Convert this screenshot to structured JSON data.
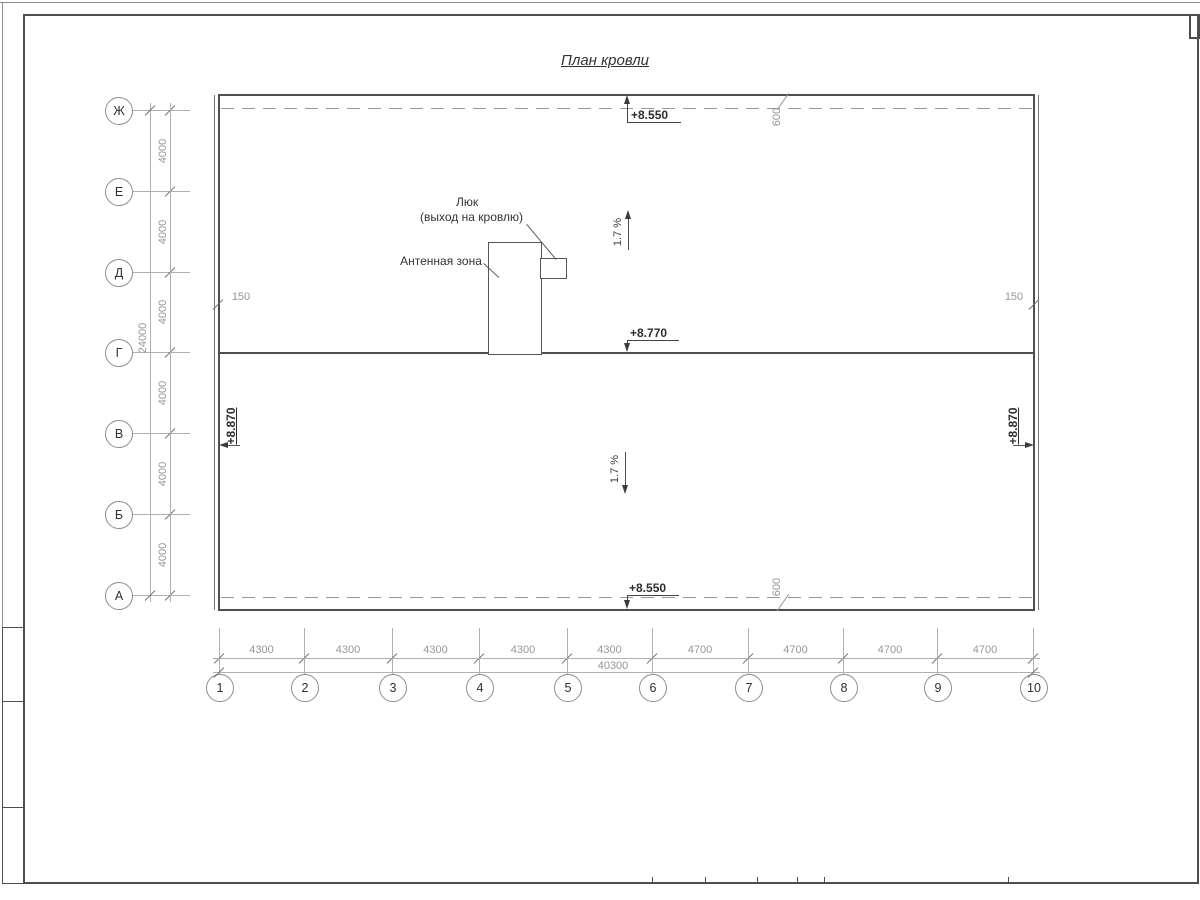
{
  "title": "План кровли",
  "axes": {
    "rows": [
      "Ж",
      "Е",
      "Д",
      "Г",
      "В",
      "Б",
      "А"
    ],
    "row_spans": [
      "4000",
      "4000",
      "4000",
      "4000",
      "4000",
      "4000"
    ],
    "row_total": "24000",
    "cols": [
      "1",
      "2",
      "3",
      "4",
      "5",
      "6",
      "7",
      "8",
      "9",
      "10"
    ],
    "col_spans": [
      "4300",
      "4300",
      "4300",
      "4300",
      "4300",
      "4700",
      "4700",
      "4700",
      "4700"
    ],
    "col_total": "40300"
  },
  "marks": {
    "top_elevation": "+8.550",
    "ridge_elevation": "+8.770",
    "bottom_elevation": "+8.550",
    "left_elevation": "+8.870",
    "right_elevation": "+8.870",
    "parapet_top": "600",
    "parapet_bottom": "600",
    "edge_left": "150",
    "edge_right": "150",
    "slope_up": "1.7 %",
    "slope_down": "1.7 %"
  },
  "annotations": {
    "hatch_title": "Люк",
    "hatch_subtitle": "(выход на кровлю)",
    "antenna": "Антенная зона"
  },
  "colors": {
    "line_dark": "#4f4f4f",
    "line_dim": "#b0b0b0",
    "text_dark": "#333333",
    "text_dim": "#969696"
  }
}
